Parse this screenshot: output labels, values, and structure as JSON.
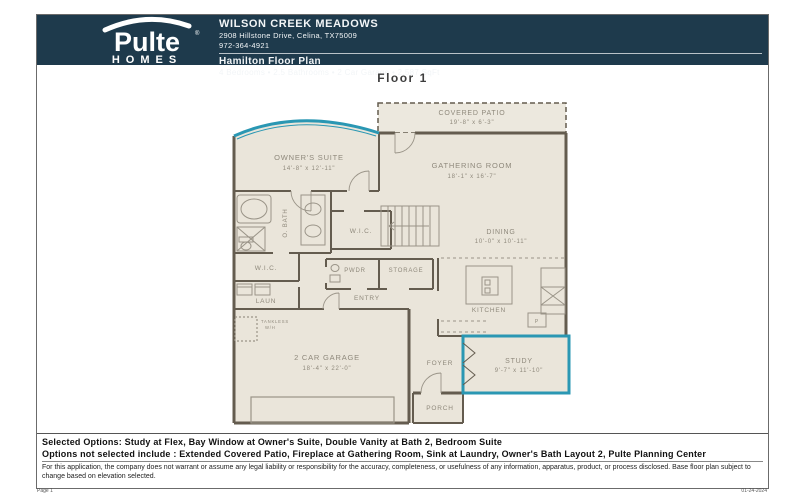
{
  "colors": {
    "header_bg": "#1e3a4c",
    "accent_teal": "#2a97b3",
    "wall": "#645c4f",
    "room_fill": "#eae5da",
    "plan_text": "#8f897c"
  },
  "header": {
    "logo": {
      "brand": "Pulte",
      "reg": "®",
      "sub": "HOMES"
    },
    "community": "WILSON CREEK MEADOWS",
    "address": "2908 Hillstone Drive, Celina, TX75009",
    "phone": "972-364-4921",
    "plan_name": "Hamilton Floor Plan",
    "plan_specs": "4 Bedrooms  •  2.5 Bathrooms  •  2 Car Garage  •  2,587 SqFt"
  },
  "floor_label": "Floor 1",
  "plan": {
    "rooms": {
      "covered_patio": {
        "name": "COVERED PATIO",
        "dims": "19'-8\" x 6'-3\""
      },
      "owners_suite": {
        "name": "OWNER'S SUITE",
        "dims": "14'-8\" x 12'-11\""
      },
      "gathering_room": {
        "name": "GATHERING ROOM",
        "dims": "18'-1\" x 16'-7\""
      },
      "dining": {
        "name": "DINING",
        "dims": "10'-0\" x 10'-11\""
      },
      "owners_bath": {
        "name": "O. BATH"
      },
      "wic1": {
        "name": "W.I.C."
      },
      "wic2": {
        "name": "W.I.C."
      },
      "pwdr": {
        "name": "PWDR"
      },
      "storage": {
        "name": "STORAGE"
      },
      "laundry": {
        "name": "LAUN"
      },
      "entry": {
        "name": "ENTRY"
      },
      "kitchen": {
        "name": "KITCHEN"
      },
      "pantry": {
        "name": "P"
      },
      "garage": {
        "name": "2 CAR GARAGE",
        "dims": "18'-4\" x 22'-0\""
      },
      "foyer": {
        "name": "FOYER"
      },
      "study": {
        "name": "STUDY",
        "dims": "9'-7\" x 11'-10\""
      },
      "porch": {
        "name": "PORCH"
      },
      "tankless": {
        "line1": "TANKLESS",
        "line2": "W/H"
      }
    }
  },
  "footer": {
    "selected_options": "Selected Options: Study at Flex, Bay Window at Owner's Suite, Double Vanity at Bath 2, Bedroom Suite",
    "options_not_selected": "Options not selected include : Extended Covered Patio, Fireplace at Gathering Room, Sink at Laundry, Owner's Bath Layout 2, Pulte Planning Center",
    "disclaimer": "For this application, the company does not warrant or assume any legal liability or responsibility for the accuracy, completeness, or usefulness of any information, apparatus, product, or process disclosed. Base floor plan subject to change based on elevation selected.",
    "page_number": "Page 1",
    "date": "01-24-2024"
  }
}
